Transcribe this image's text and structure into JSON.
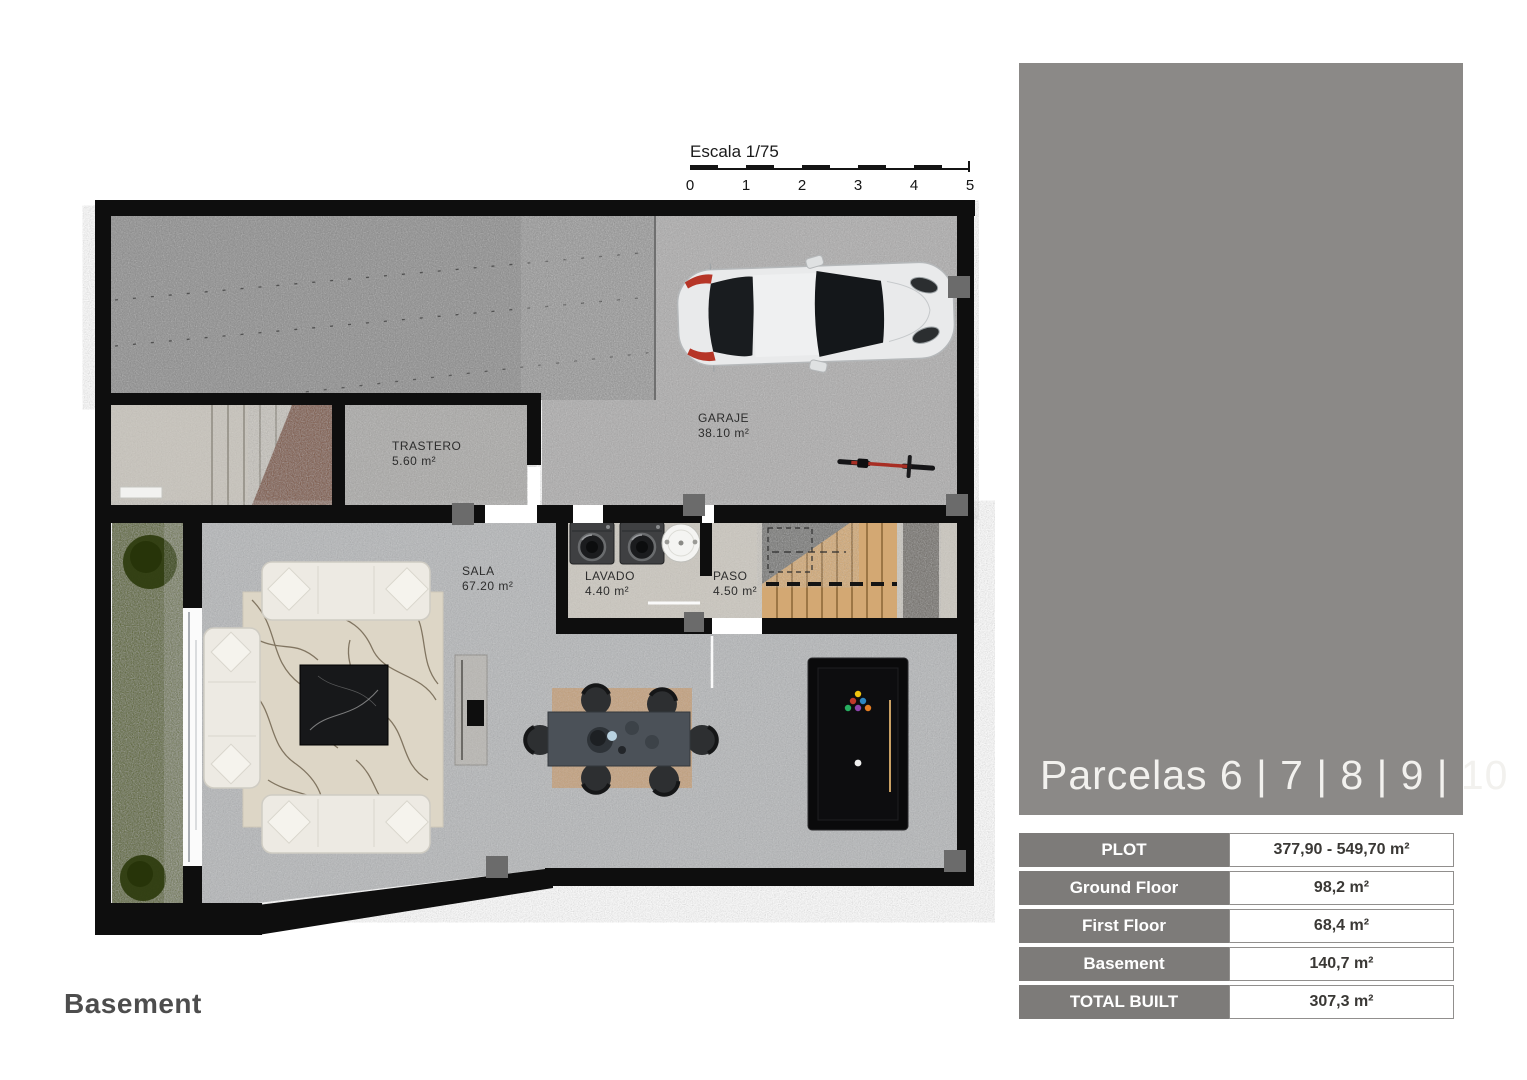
{
  "theme": {
    "panel_bg": "#8b8987",
    "table_label_bg": "#7d7b79",
    "wall_color": "#0e0e0e",
    "garden_green": "#55601c",
    "stair_wood": "#d3a873"
  },
  "floor_plan": {
    "caption": "Basement",
    "scale_bar": {
      "label": "Escala 1/75",
      "ticks": [
        "0",
        "1",
        "2",
        "3",
        "4",
        "5"
      ]
    },
    "rooms": [
      {
        "name": "TRASTERO",
        "area": "5.60 m²"
      },
      {
        "name": "GARAJE",
        "area": "38.10 m²"
      },
      {
        "name": "SALA",
        "area": "67.20 m²"
      },
      {
        "name": "LAVADO",
        "area": "4.40 m²"
      },
      {
        "name": "PASO",
        "area": "4.50 m²"
      }
    ]
  },
  "side_panel": {
    "title": "Parcelas 6 | 7 | 8 | 9 | 10"
  },
  "spec_table": {
    "rows": [
      {
        "label": "PLOT",
        "value": "377,90 - 549,70 m²"
      },
      {
        "label": "Ground Floor",
        "value": "98,2 m²"
      },
      {
        "label": "First Floor",
        "value": "68,4 m²"
      },
      {
        "label": "Basement",
        "value": "140,7 m²"
      },
      {
        "label": "TOTAL BUILT",
        "value": "307,3 m²"
      }
    ]
  }
}
